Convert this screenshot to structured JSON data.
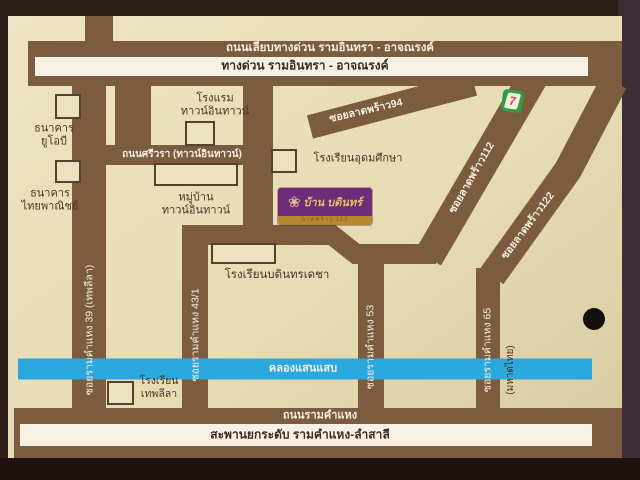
{
  "expressway": {
    "frontage": "ถนนเลียบทางด่วน รามอินทรา - อาจณรงค์",
    "main": "ทางด่วน รามอินทรา - อาจณรงค์"
  },
  "roads": {
    "srivara": "ถนนศรีวรา (ทาวน์อินทาวน์)",
    "ladprao94": "ซอยลาดพร้าว94",
    "ladprao112": "ซอยลาดพร้าว112",
    "ladprao122": "ซอยลาดพร้าว122",
    "ramkhamhaeng39": "ซอยรามคำแหง 39 (เทพลีลา)",
    "ramkhamhaeng43_1": "ซอยรามคำแหง 43/1",
    "ramkhamhaeng53": "ซอยรามคำแหง 53",
    "ramkhamhaeng65": "ซอยรามคำแหง 65",
    "mahadthai": "(มหาดไทย)",
    "ramkhamhaeng": "ถนนรามคำแหง",
    "flyover": "สะพานยกระดับ รามคำแหง-ลำสาลี"
  },
  "canal": {
    "label": "คลองแสนแสบ"
  },
  "places": {
    "uob_bank": "ธนาคาร\nยูโอบี",
    "scb_bank": "ธนาคาร\nไทยพาณิชย์",
    "town_in_town_hotel": "โรงแรม\nทาวน์อินทาวน์",
    "udomsuksa_school": "โรงเรียนอุดมศึกษา",
    "town_in_town_village": "หมู่บ้าน\nทาวน์อินทาวน์",
    "bodindecha_school": "โรงเรียนบดินทรเดชา",
    "thepleela_school": "โรงเรียน\nเทพลีลา"
  },
  "logo": {
    "title": "บ้าน บดินทร์",
    "subtitle": "ลาดพร้าว 112",
    "flower_icon": "❀"
  },
  "seven_eleven": {
    "digit": "7"
  },
  "colors": {
    "card": "#e8dcb6",
    "road_brown": "#7b5c3e",
    "canal_blue": "#2ba9de",
    "stripe_white": "#f6f1e2",
    "logo_purple": "#6d2b79",
    "logo_gold": "#b5882f",
    "photo_background": "#261a14"
  }
}
